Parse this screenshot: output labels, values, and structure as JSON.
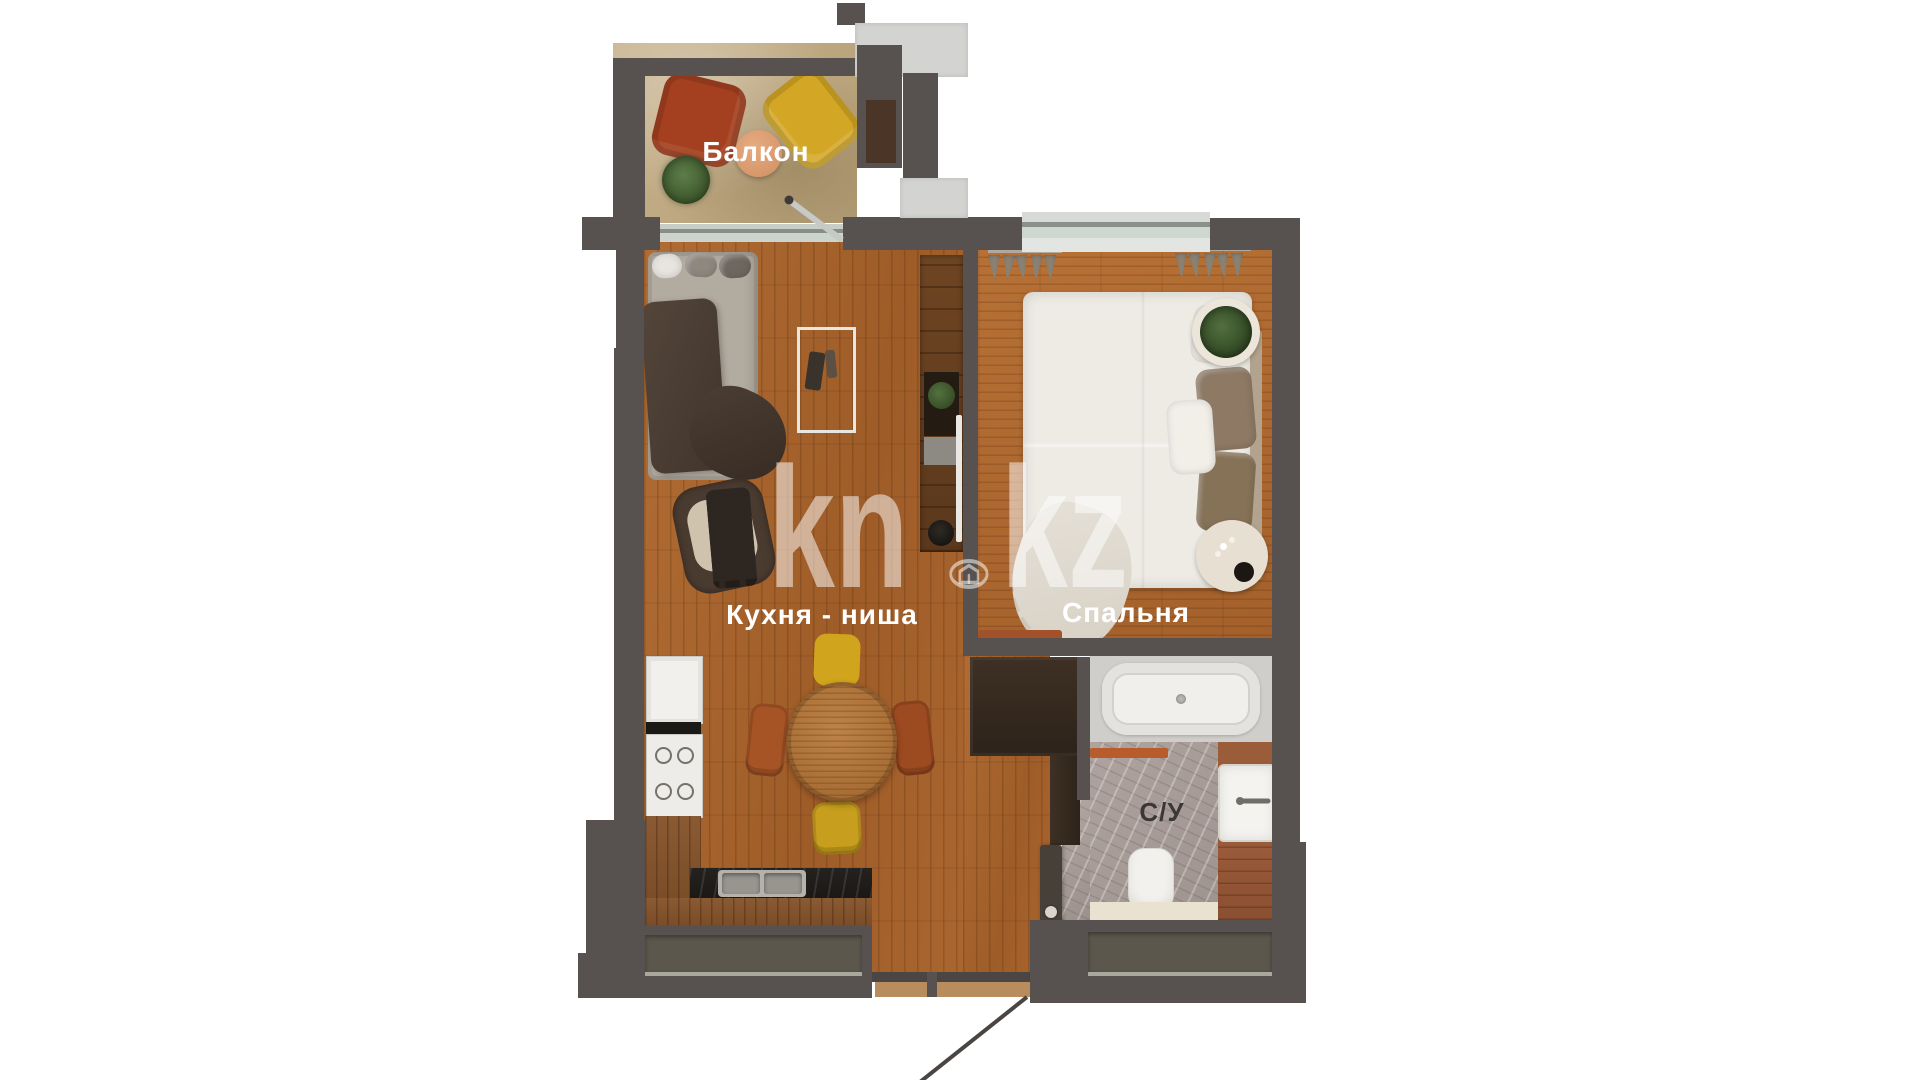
{
  "plan": {
    "title": "apartment floor plan",
    "rooms": [
      {
        "id": "balcony",
        "label": "Балкон"
      },
      {
        "id": "kitchen",
        "label": "Кухня - ниша"
      },
      {
        "id": "bedroom",
        "label": "Спальня"
      },
      {
        "id": "bathroom",
        "label": "С/У"
      }
    ]
  },
  "watermark": {
    "part1": "kn",
    "part2": "kz",
    "icon": "house-in-circle",
    "opacity": "0.52"
  },
  "colors": {
    "wall": "#57524f",
    "concrete": "#d3d4d2",
    "living_floor": "#a9642d",
    "bedroom_floor": "#ad6930",
    "balcony_floor": "#c2ab85",
    "bathroom_marble": "#a89e9a",
    "counter_black": "#201d1a",
    "accent_yellow": "#d0a41c",
    "accent_rust": "#9c4a20",
    "accent_red": "#a4401f",
    "closet_brown": "#3c2e22",
    "label_white": "#ffffff",
    "label_dark": "#3b3734"
  }
}
